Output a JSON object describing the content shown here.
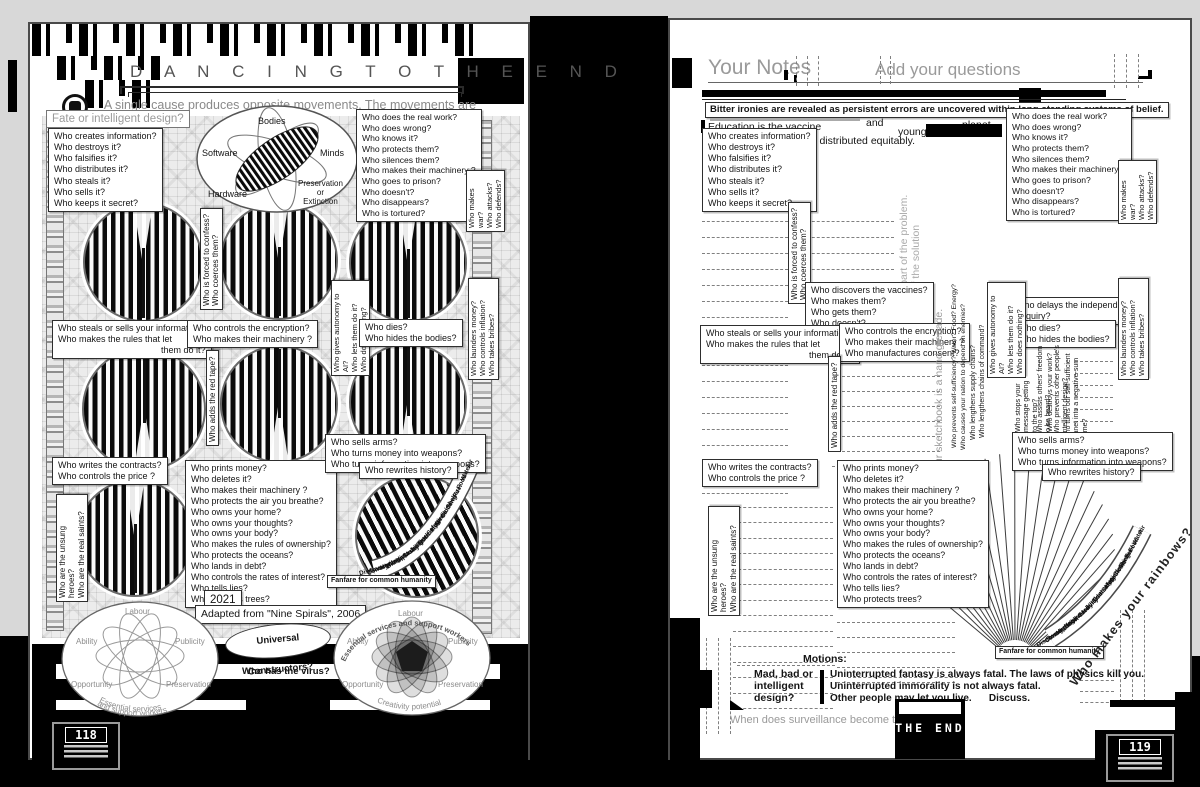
{
  "colors": {
    "ink": "#111111",
    "paper": "#ffffff",
    "muted": "#999999"
  },
  "questions": {
    "info": [
      "Who creates information?",
      "Who destroys it?",
      "Who falsifies it?",
      "Who distributes it?",
      "Who steals it?",
      "Who sells it?",
      "Who keeps it secret?"
    ],
    "work": [
      "Who does the  real work?",
      "Who does wrong?",
      "Who knows it?",
      "Who protects them?",
      "Who silences them?",
      "Who makes their machinery ?",
      "Who goes to prison?",
      "Who doesn't?",
      "Who disappears?",
      "Who is tortured?"
    ],
    "war": "Who makes war?\nWho attacks?\nWho defends?",
    "confess": "Who is forced to confess?\nWho coerces them?",
    "steals": [
      "Who steals or sells your information?",
      "Who makes the rules that let",
      "them do it?"
    ],
    "encryption": [
      "Who controls the encryption?",
      "Who makes their machinery ?"
    ],
    "encryption_r": [
      "Who controls the encryption?",
      "Who makes their machinery ?",
      "Who manufactures consent?"
    ],
    "autonomy": "Who gives autonomy to AI?\nWho lets them do it?\nWho does nothing?",
    "dies": [
      "Who dies?",
      "Who hides the bodies?"
    ],
    "launders": "Who launders money?\nWho controls inflation?\nWho takes bribes?",
    "red_tape": "Who adds the red tape?",
    "contracts": [
      "Who writes the contracts?",
      "Who controls the price ?"
    ],
    "money": [
      "Who prints money?",
      "Who deletes it?",
      "Who makes their machinery ?",
      "Who protects the air you breathe?",
      "Who owns your home?",
      "Who owns your thoughts?",
      "Who owns your body?",
      "Who makes the rules of ownership?",
      "Who protects the oceans?",
      "Who lands in debt?",
      "Who controls the rates of interest?",
      "Who tells lies?",
      "Who protects trees?"
    ],
    "arms": [
      "Who sells arms?",
      "Who turns money into weapons?",
      "Who turns information into weapons?"
    ],
    "rewrites": "Who rewrites history?",
    "heroes": "Who are the unsung heroes?\nWho are the real saints?",
    "vaccines": [
      "Who discovers the vaccines?",
      "Who makes them?",
      "Who gets them?",
      "Who doesn't?"
    ],
    "delays": [
      "Who delays the independent",
      "enquiry?"
    ],
    "supply1": "Who prevents self-sufficiency? Water? Food? Energy?",
    "supply2": "Who causes your nation to depend on enemies?",
    "supply3": "Who lengthens supply chains?",
    "supply4": "Who lengthens chains of command?",
    "stops1": "Who stops your\nmessage getting\nto the top?",
    "stops2": "Who assists others' freedom\nto be heard?",
    "stops3": "Who destroys your work?",
    "stops4": "Who prevents other people's\nintelligent design?",
    "stops5": "Who turns our self-sufficient\nplanet into a negative-sum\ngame?"
  },
  "fan": {
    "words": [
      "Air",
      "Water",
      "Food",
      "Fuel",
      "Shelter",
      "Clothing",
      "Medicine",
      "Hygiene",
      "Safety",
      "Education",
      "Truth",
      "Justice",
      "Mobility",
      "Care",
      "Bio-diversity",
      "Nature",
      "Heritage",
      "Conservation",
      "Beauty",
      "Discovery"
    ],
    "banner": "Fanfare for common humanity",
    "rainbows": "Who makes your rainbows?"
  },
  "left_page": {
    "title": "D A N C I N G   T O   T H E   E N D",
    "subtitle": "A single cause produces opposite movements. The movements are continuous.",
    "fate": "Fate or intelligent design?",
    "venn": {
      "top": "Bodies",
      "left": "Software",
      "right": "Minds",
      "bottom_left": "Hardware",
      "bottom_right": "Preservation\nor\nExtinction"
    },
    "year": "2021",
    "adapted": "Adapted from \"Nine Spirals\", 2006",
    "lens": "Universal Constructors?",
    "virus": "Who has the virus?",
    "page_number": "118",
    "atom": {
      "top": "Labour",
      "left": "Ability",
      "right": "Publicity",
      "bottom_left": "Opportunity",
      "bottom_right": "Preservation"
    },
    "atom_left_arc1": "Essential services",
    "atom_left_arc2": "and support workers",
    "atom_right_arc_top": "Essential services and support workers",
    "atom_right_arc_bottom": "Creativity potential"
  },
  "right_page": {
    "notes_title": "Your Notes",
    "add_title": "Add your questions",
    "ironies": "Bitter ironies are revealed as persistent errors are uncovered within long-standing systems of belief.",
    "education": "Education is the vaccine",
    "and_word": "and",
    "planet_word": "planet.",
    "equitably": "should be distributed equitably.",
    "young_word": "young",
    "problem": "If you are not part of the problem.\nYou are part of the solution",
    "sketchbook": "Your sketchbook is a hand grenade.",
    "motions": "Motions:",
    "mad_bad": "Mad, bad or\nintelligent\ndesign?",
    "fatal1": "Uninterrupted fantasy is always fatal. The laws of physics kill you.",
    "fatal2": "Uninterrupted immorality is not always fatal.",
    "fatal3": "Other people may let you live.",
    "discuss": "Discuss.",
    "surveillance": "When does surveillance become theft?",
    "the_end": "THE END",
    "page_number": "119"
  }
}
